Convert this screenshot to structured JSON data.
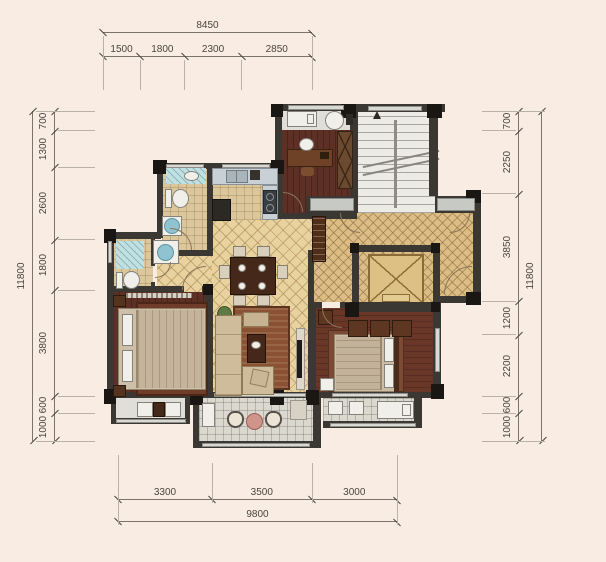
{
  "drawing": {
    "type": "residential floor plan",
    "background_color": "#f9ece2",
    "wall_color": "#3b3733",
    "dimension_text_color": "#4a453f",
    "wood_floor_color": "#5e2f24",
    "living_tile_color": "#e8d2a0",
    "lobby_tile_color": "#dcbd86",
    "elevator_cab_color": "#dcc084"
  },
  "dimensions": {
    "top": {
      "total": "8450",
      "segments": [
        "1500",
        "1800",
        "2300",
        "2850"
      ]
    },
    "left": {
      "total": "11800",
      "segments": [
        "700",
        "1300",
        "2600",
        "1800",
        "3800",
        "600",
        "1000"
      ]
    },
    "right": {
      "total": "11800",
      "segments": [
        "700",
        "2250",
        "3850",
        "1200",
        "2200",
        "600",
        "1000"
      ]
    },
    "bottom": {
      "total": "9800",
      "segments": [
        "3300",
        "3500",
        "3000"
      ]
    }
  }
}
